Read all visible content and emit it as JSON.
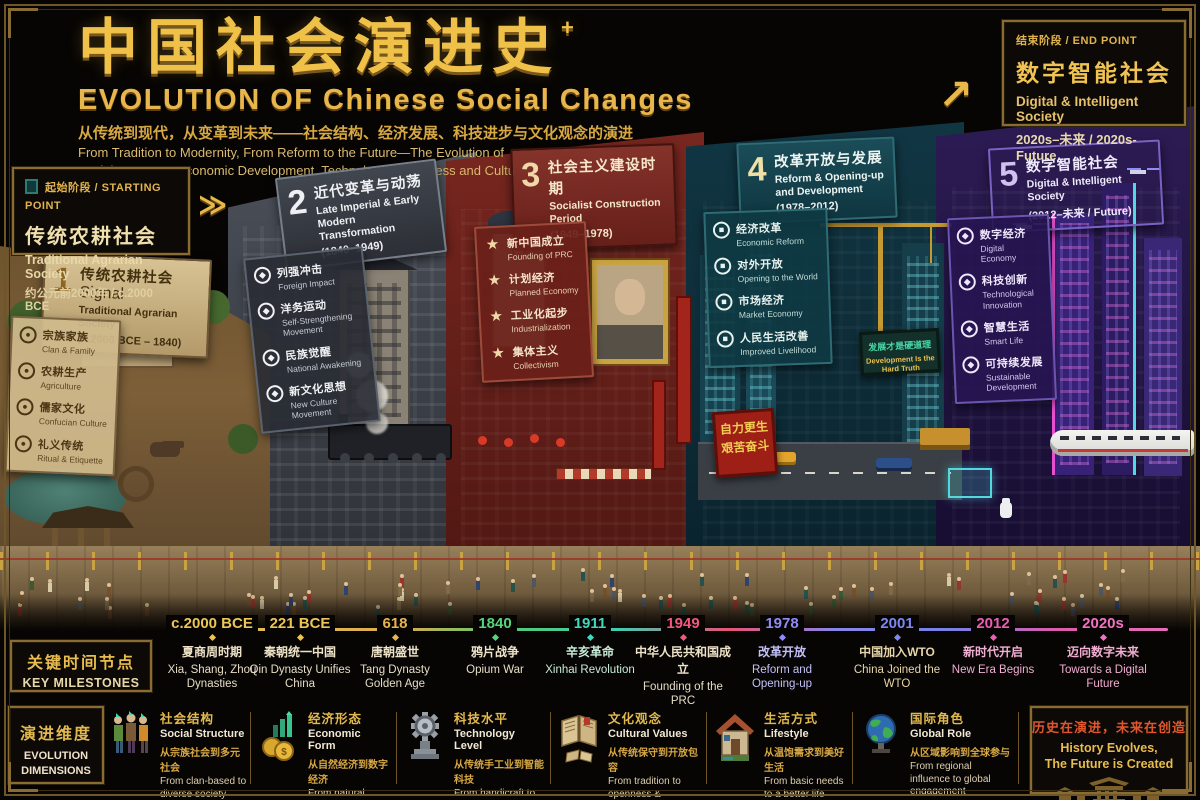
{
  "header": {
    "title_zh": "中国社会演进史",
    "title_plus": "+",
    "title_en": "EVOLUTION OF Chinese Social Changes",
    "subtitle_zh": "从传统到现代，从变革到未来——社会结构、经济发展、科技进步与文化观念的演进",
    "subtitle_en_line1": "From Tradition to Modernity, From Reform to the Future—The Evolution of",
    "subtitle_en_line2": "Social Structure, Economic Development, Technological Progress and Cultural Values"
  },
  "start_point": {
    "label": "起始阶段 / STARTING POINT",
    "title_zh": "传统农耕社会",
    "title_en": "Traditional Agrarian Society",
    "time": "约公元前2000年 / c.2000 BCE"
  },
  "end_point": {
    "label": "结束阶段 / END POINT",
    "title_zh": "数字智能社会",
    "title_en": "Digital & Intelligent Society",
    "time": "2020s–未来 / 2020s-Future"
  },
  "arrows": {
    "start": "≫",
    "end": "↗"
  },
  "stages": [
    {
      "num": "1",
      "title_zh": "传统农耕社会",
      "title_en": "Traditional Agrarian Society",
      "years": "(c.2000 BCE – 1840)",
      "accent": "#c9b488",
      "items": [
        {
          "zh": "宗族家族",
          "en": "Clan & Family"
        },
        {
          "zh": "农耕生产",
          "en": "Agriculture"
        },
        {
          "zh": "儒家文化",
          "en": "Confucian Culture"
        },
        {
          "zh": "礼义传统",
          "en": "Ritual & Etiquette"
        }
      ]
    },
    {
      "num": "2",
      "title_zh": "近代变革与动荡",
      "title_en": "Late Imperial & Early Modern Transformation",
      "years": "(1840–1949)",
      "accent": "#3f444d",
      "items": [
        {
          "zh": "列强冲击",
          "en": "Foreign Impact"
        },
        {
          "zh": "洋务运动",
          "en": "Self-Strengthening Movement"
        },
        {
          "zh": "民族觉醒",
          "en": "National Awakening"
        },
        {
          "zh": "新文化思想",
          "en": "New Culture Movement"
        }
      ]
    },
    {
      "num": "3",
      "title_zh": "社会主义建设时期",
      "title_en": "Socialist Construction Period",
      "years": "(1949–1978)",
      "accent": "#7b2a22",
      "items": [
        {
          "zh": "新中国成立",
          "en": "Founding of PRC"
        },
        {
          "zh": "计划经济",
          "en": "Planned Economy"
        },
        {
          "zh": "工业化起步",
          "en": "Industrialization"
        },
        {
          "zh": "集体主义",
          "en": "Collectivism"
        }
      ]
    },
    {
      "num": "4",
      "title_zh": "改革开放与发展",
      "title_en": "Reform & Opening-up and Development",
      "years": "(1978–2012)",
      "accent": "#15454f",
      "items": [
        {
          "zh": "经济改革",
          "en": "Economic Reform"
        },
        {
          "zh": "对外开放",
          "en": "Opening to the World"
        },
        {
          "zh": "市场经济",
          "en": "Market Economy"
        },
        {
          "zh": "人民生活改善",
          "en": "Improved Livelihood"
        }
      ]
    },
    {
      "num": "5",
      "title_zh": "数字智能社会",
      "title_en": "Digital & Intelligent Society",
      "years": "(2012–未来 / Future)",
      "accent": "#2d1d52",
      "items": [
        {
          "zh": "数字经济",
          "en": "Digital Economy"
        },
        {
          "zh": "科技创新",
          "en": "Technological Innovation"
        },
        {
          "zh": "智慧生活",
          "en": "Smart Life"
        },
        {
          "zh": "可持续发展",
          "en": "Sustainable Development"
        }
      ]
    }
  ],
  "scene_text": {
    "slogan_banner": {
      "line1": "自力更生",
      "line2": "艰苦奋斗"
    },
    "billboard": {
      "zh": "发展才是硬道理",
      "en": "Development Is the Hard Truth"
    }
  },
  "milestones_panel": {
    "title_zh": "关键时间节点",
    "title_en": "KEY MILESTONES"
  },
  "milestones": [
    {
      "year": "c.2000 BCE",
      "zh": "夏商周时期",
      "en": "Xia, Shang, Zhou Dynasties",
      "color": "#ecc557"
    },
    {
      "year": "221 BCE",
      "zh": "秦朝统一中国",
      "en": "Qin Dynasty Unifies China",
      "color": "#ecc557"
    },
    {
      "year": "618",
      "zh": "唐朝盛世",
      "en": "Tang Dynasty Golden Age",
      "color": "#e8b44e"
    },
    {
      "year": "1840",
      "zh": "鸦片战争",
      "en": "Opium War",
      "color": "#56d47a"
    },
    {
      "year": "1911",
      "zh": "辛亥革命",
      "en": "Xinhai Revolution",
      "color": "#41d8bd",
      "tint": "#c8ecd8"
    },
    {
      "year": "1949",
      "zh": "中华人民共和国成立",
      "en": "Founding of the PRC",
      "color": "#f4577e"
    },
    {
      "year": "1978",
      "zh": "改革开放",
      "en": "Reform and Opening-up",
      "color": "#8f8cf6",
      "tint": "#c3c1f8"
    },
    {
      "year": "2001",
      "zh": "中国加入WTO",
      "en": "China Joined the WTO",
      "color": "#7d87f2",
      "tint": "#e5d5a8"
    },
    {
      "year": "2012",
      "zh": "新时代开启",
      "en": "New Era Begins",
      "color": "#ea5fb4",
      "tint": "#f0aed2"
    },
    {
      "year": "2020s",
      "zh": "迈向数字未来",
      "en": "Towards a Digital Future",
      "color": "#f272c4",
      "tint": "#f0aed2"
    }
  ],
  "dimensions_panel": {
    "title_zh": "演进维度",
    "title_en_line1": "EVOLUTION",
    "title_en_line2": "DIMENSIONS"
  },
  "dimensions": [
    {
      "icon": "people-icon",
      "zh": "社会结构",
      "en": "Social Structure",
      "sub_zh": "从宗族社会到多元社会",
      "sub_en": "From clan-based to diverse society"
    },
    {
      "icon": "coins-chart-icon",
      "zh": "经济形态",
      "en": "Economic Form",
      "sub_zh": "从自然经济到数字经济",
      "sub_en": "From natural economy to digital economy"
    },
    {
      "icon": "gear-icon",
      "zh": "科技水平",
      "en": "Technology Level",
      "sub_zh": "从传统手工业到智能科技",
      "sub_en": "From handicraft to intelligent technology"
    },
    {
      "icon": "book-icon",
      "zh": "文化观念",
      "en": "Cultural Values",
      "sub_zh": "从传统保守到开放包容",
      "sub_en": "From tradition to openness & inclusivity"
    },
    {
      "icon": "house-icon",
      "zh": "生活方式",
      "en": "Lifestyle",
      "sub_zh": "从温饱需求到美好生活",
      "sub_en": "From basic needs to a better life"
    },
    {
      "icon": "globe-icon",
      "zh": "国际角色",
      "en": "Global Role",
      "sub_zh": "从区域影响到全球参与",
      "sub_en": "From regional influence to global engagement"
    }
  ],
  "footer": {
    "zh": "历史在演进，未来在创造",
    "en_line1": "History Evolves,",
    "en_line2": "The Future is Created"
  }
}
